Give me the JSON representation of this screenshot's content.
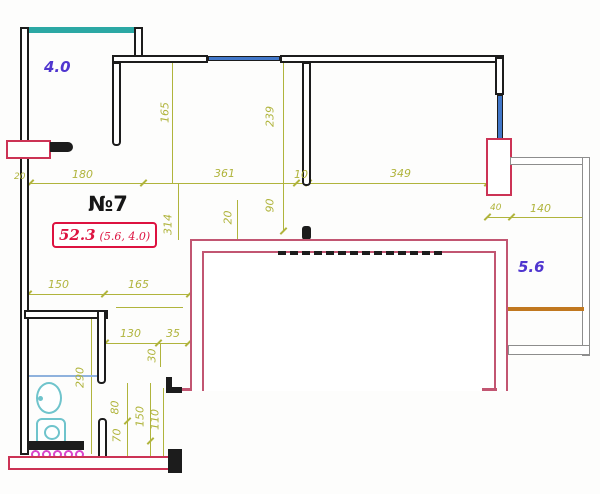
{
  "colors": {
    "wall": "#1c1c1c",
    "red": "#cc3355",
    "redtext": "#dd1240",
    "pink": "#c25672",
    "gray": "#8d8d8d",
    "dim": "#b0b43c",
    "purple": "#4f35cf",
    "teal": "#2ba8a4",
    "fixture": "#6fc4cc",
    "window": "#4177c9",
    "orange": "#c1781f",
    "magenta": "#d944cb"
  },
  "plan": {
    "unit_label": "№7",
    "area_total": "52.3",
    "area_detail": "(5.6, 4.0)",
    "balcony_top_left_area": "4.0",
    "balcony_right_area": "5.6"
  },
  "dimensions": {
    "top_20": "20",
    "top_180": "180",
    "top_361": "361",
    "top_10": "10",
    "top_349": "349",
    "right_40": "40",
    "right_140": "140",
    "v_165": "165",
    "v_239": "239",
    "v_314": "314",
    "v_20": "20",
    "v_90": "90",
    "mid_150": "150",
    "mid_165": "165",
    "low_130": "130",
    "low_35": "35",
    "v_30": "30",
    "v_290": "290",
    "v_80": "80",
    "v_70": "70",
    "v_150": "150",
    "v_110": "110"
  }
}
